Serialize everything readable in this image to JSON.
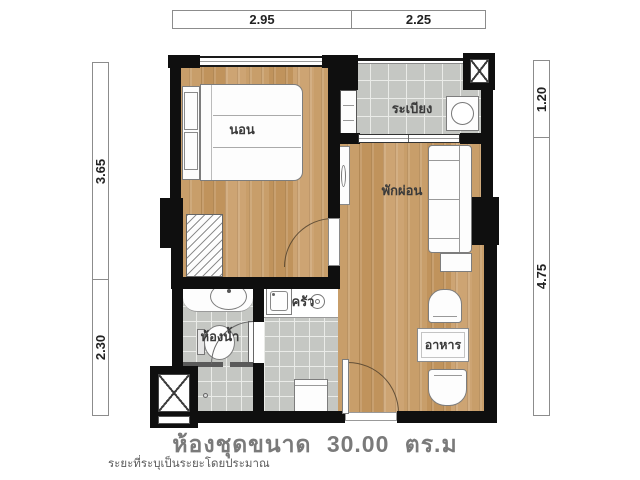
{
  "plan": {
    "caption": "ห้องชุดขนาด 30.00 ตร.ม",
    "note": "ระยะที่ระบุเป็นระยะโดยประมาณ",
    "area_sqm": "30.00",
    "rooms": {
      "bedroom": "นอน",
      "balcony": "ระเบียง",
      "living": "พักผ่อน",
      "kitchen": "ครัว",
      "bathroom": "ห้องน้ำ",
      "dining": "อาหาร"
    },
    "dimensions": {
      "top": [
        "2.95",
        "2.25"
      ],
      "left": [
        "3.65",
        "2.30"
      ],
      "right": [
        "1.20",
        "4.75"
      ]
    },
    "colors": {
      "wall": "#0f0f0f",
      "wood_floor": "#c79a62",
      "tile_floor": "#c5c7c3",
      "caption_text": "#7a7a7a"
    }
  }
}
